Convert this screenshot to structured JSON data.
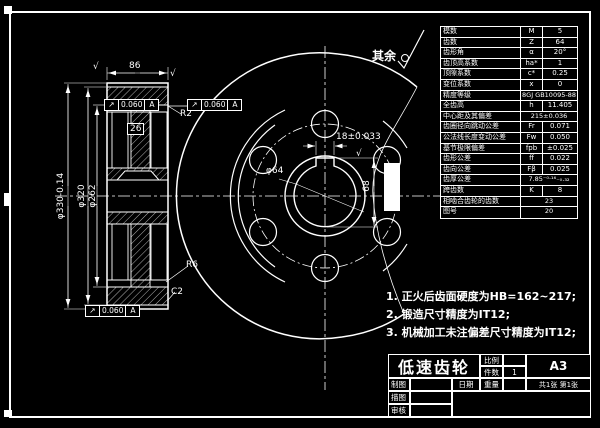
{
  "surface_note": {
    "label": "其余",
    "symbol": "roughness-check-icon"
  },
  "param_table": {
    "rows": [
      {
        "label": "模数",
        "sym": "M",
        "val": "5"
      },
      {
        "label": "齿数",
        "sym": "Z",
        "val": "64"
      },
      {
        "label": "齿形角",
        "sym": "α",
        "val": "20°"
      },
      {
        "label": "齿顶高系数",
        "sym": "ha*",
        "val": "1"
      },
      {
        "label": "顶隙系数",
        "sym": "c*",
        "val": "0.25"
      },
      {
        "label": "变位系数",
        "sym": "x",
        "val": "0"
      },
      {
        "label": "精度等级",
        "sym": "",
        "val": "8GJ GB10095-88",
        "span": true
      },
      {
        "label": "全齿高",
        "sym": "h",
        "val": "11.405"
      },
      {
        "label": "中心距及其偏差",
        "sym": "",
        "val": "215±0.036",
        "span": true
      },
      {
        "label": "齿圈径向跳动公差",
        "sym": "Fr",
        "val": "0.071"
      },
      {
        "label": "公法线长度变动公差",
        "sym": "Fw",
        "val": "0.050"
      },
      {
        "label": "基节极限偏差",
        "sym": "fpb",
        "val": "±0.025"
      },
      {
        "label": "齿形公差",
        "sym": "ff",
        "val": "0.022"
      },
      {
        "label": "齿向公差",
        "sym": "Fβ",
        "val": "0.025"
      },
      {
        "label": "齿厚公差",
        "sym": "",
        "val": "7.85⁻⁰·¹⁶₋₀.₃₂",
        "span": true
      },
      {
        "label": "跨齿数",
        "sym": "K",
        "val": "8"
      },
      {
        "label": "相啮合齿轮的齿数",
        "sym": "",
        "val": "23",
        "span": true
      },
      {
        "label": "图号",
        "sym": "",
        "val": "20",
        "span": true
      }
    ]
  },
  "notes": {
    "items": [
      "1. 正火后齿面硬度为HB=162~217;",
      "2. 锻造尺寸精度为IT12;",
      "3. 机械加工未注偏差尺寸精度为IT12;"
    ]
  },
  "title_block": {
    "title": "低速齿轮",
    "paper": "A3",
    "scale_label": "比例",
    "scale_value": "",
    "qty_label": "件数",
    "qty_value": "1",
    "drawn_label": "制图",
    "drawn_value": "",
    "date_label": "日期",
    "weight_label": "重量",
    "weight_value": "",
    "sheets_note": "共1张 第1张",
    "traced_label": "描图",
    "traced_value": "",
    "checked_label": "审核",
    "checked_value": ""
  },
  "dims": {
    "labels": [
      {
        "text": "86",
        "x": 129,
        "y": 61
      },
      {
        "text": "26",
        "x": 127,
        "y": 123,
        "cls": "boxed"
      },
      {
        "text": "R2",
        "x": 180,
        "y": 109
      },
      {
        "text": "R6",
        "x": 186,
        "y": 260
      },
      {
        "text": "C2",
        "x": 171,
        "y": 287
      },
      {
        "text": "φ330-0.14",
        "x": 61,
        "y": 196,
        "cls": "rot"
      },
      {
        "text": "φ320",
        "x": 82,
        "y": 196,
        "cls": "rot"
      },
      {
        "text": "φ262",
        "x": 93,
        "y": 196,
        "cls": "rot"
      },
      {
        "text": "18±0.033",
        "x": 336,
        "y": 132
      },
      {
        "text": "68",
        "x": 367,
        "y": 186,
        "cls": "rot"
      },
      {
        "text": "φ64",
        "x": 266,
        "y": 166
      },
      {
        "text": "√",
        "x": 93,
        "y": 62,
        "cls": "rough"
      },
      {
        "text": "√",
        "x": 170,
        "y": 69,
        "cls": "rough"
      },
      {
        "text": "√",
        "x": 356,
        "y": 149,
        "cls": "rough"
      }
    ]
  },
  "datum_frames": {
    "items": [
      {
        "sym": "↗",
        "val": "0.060",
        "datum": "A",
        "x": 105,
        "y": 99
      },
      {
        "sym": "↗",
        "val": "0.060",
        "datum": "A",
        "x": 188,
        "y": 99
      },
      {
        "sym": "↗",
        "val": "0.060",
        "datum": "A",
        "x": 86,
        "y": 305
      }
    ]
  },
  "colors": {
    "background": "#000000",
    "line": "#ffffff"
  }
}
